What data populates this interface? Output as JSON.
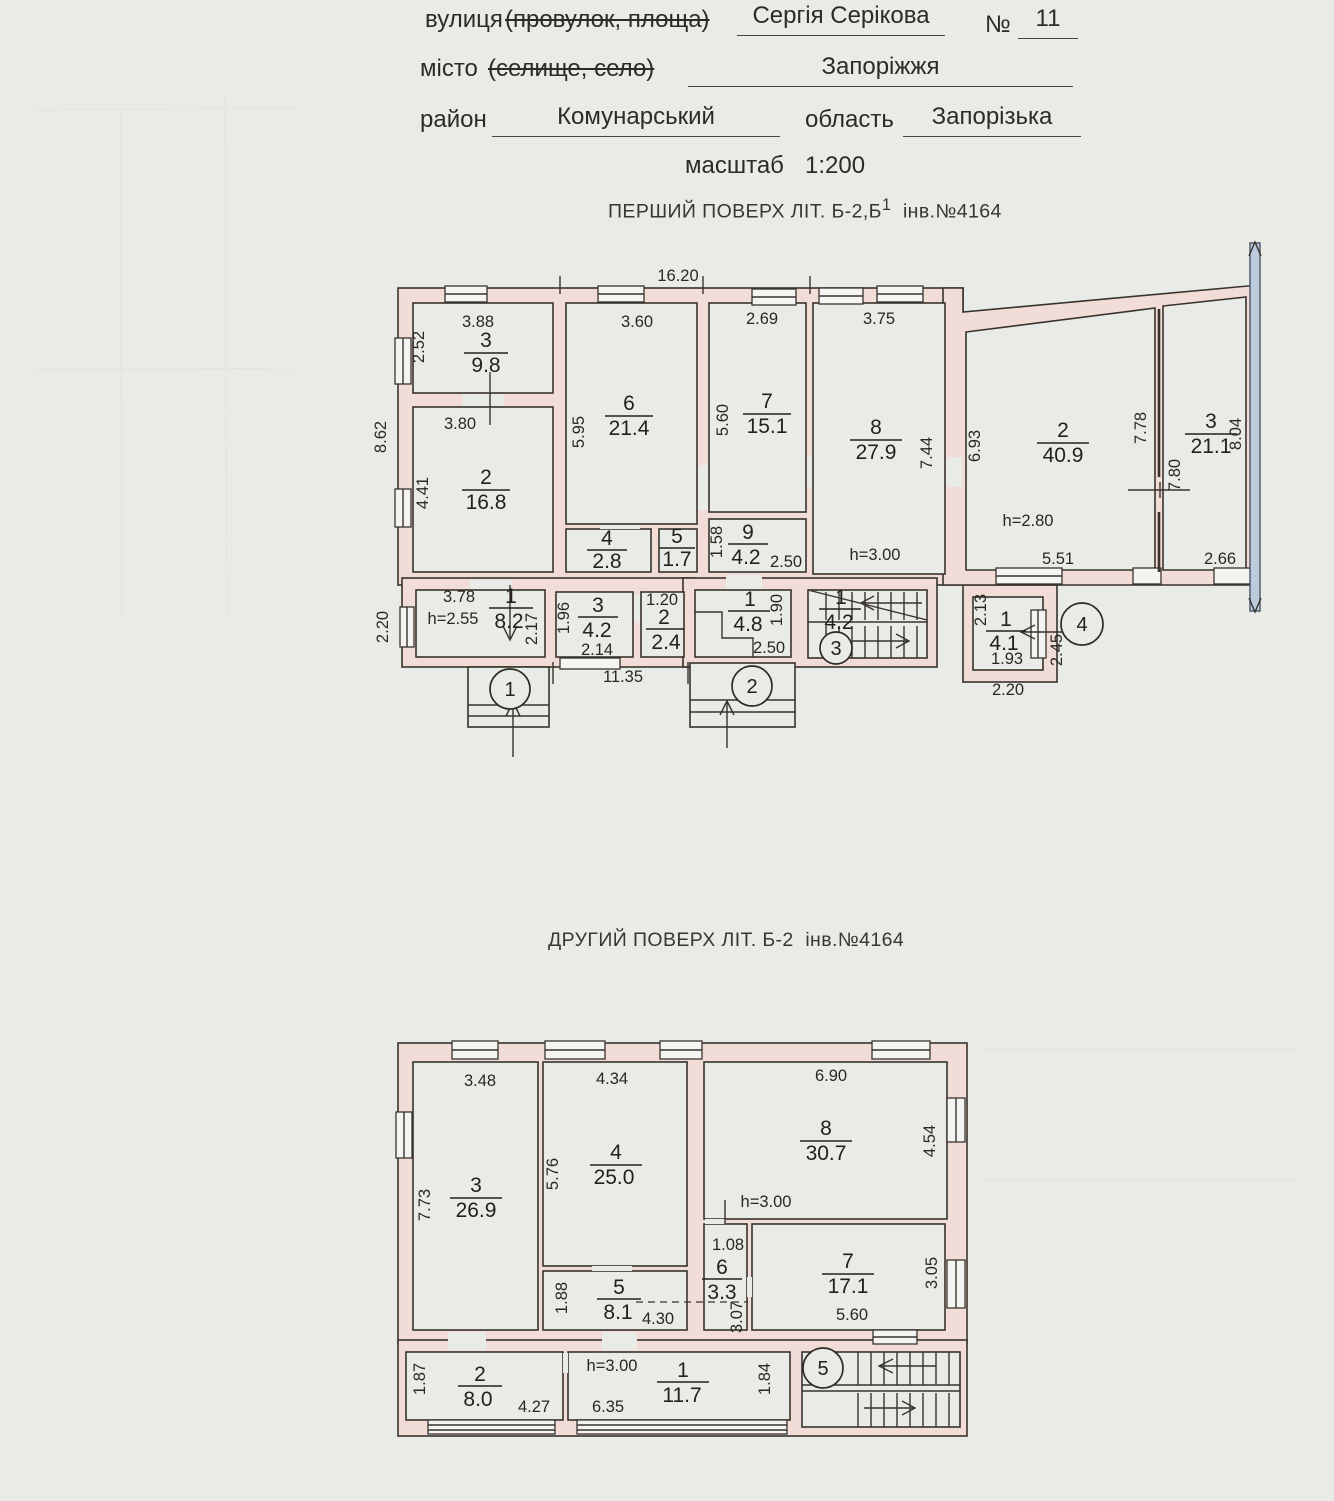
{
  "header": {
    "street_label": "вулиця",
    "street_paren": "(провулок, площа)",
    "street_value": "Сергія Серікова",
    "number_label": "№",
    "number_value": "11",
    "city_label": "місто",
    "city_paren": "(селище, село)",
    "city_value": "Запоріжжя",
    "district_label": "район",
    "district_value": "Комунарський",
    "region_label": "область",
    "region_value": "Запорізька",
    "scale_label": "масштаб",
    "scale_value": "1:200"
  },
  "floor1": {
    "title": "ПЕРШИЙ ПОВЕРХ ЛІТ. Б-2,Б",
    "title_sup": "1",
    "title_inv": "інв.№4164",
    "rooms": {
      "k3": {
        "num": "3",
        "area": "9.8"
      },
      "k2": {
        "num": "2",
        "area": "16.8"
      },
      "k6": {
        "num": "6",
        "area": "21.4"
      },
      "k4": {
        "num": "4",
        "area": "2.8"
      },
      "k5": {
        "num": "5",
        "area": "1.7"
      },
      "k7": {
        "num": "7",
        "area": "15.1"
      },
      "k8": {
        "num": "8",
        "area": "27.9"
      },
      "k9": {
        "num": "9",
        "area": "4.2"
      },
      "a2": {
        "num": "2",
        "area": "40.9"
      },
      "a3": {
        "num": "3",
        "area": "21.1"
      },
      "c1": {
        "num": "1",
        "area": "8.2"
      },
      "c3": {
        "num": "3",
        "area": "4.2"
      },
      "c2": {
        "num": "2",
        "area": "2.4"
      },
      "c48": {
        "num": "1",
        "area": "4.8"
      },
      "cst": {
        "num": "1",
        "area": "4.2"
      },
      "c41": {
        "num": "1",
        "area": "4.1"
      }
    },
    "heights": {
      "h8": "h=3.00",
      "ha2": "h=2.80",
      "hc1": "h=2.55"
    },
    "dims": {
      "top": "16.20",
      "left": "8.62",
      "left_low": "2.20",
      "r3w": "3.88",
      "r3h": "2.52",
      "r2w": "3.80",
      "r2h": "4.41",
      "r6w": "3.60",
      "r6h": "5.95",
      "r7w": "2.69",
      "r7h": "5.60",
      "r8w": "3.75",
      "r8h": "7.44",
      "r9h": "1.58",
      "r9w": "2.50",
      "annex_left": "6.93",
      "a2w": "5.51",
      "a3h1": "7.78",
      "a3h2": "7.80",
      "a3w": "2.66",
      "right": "8.04",
      "c1w": "3.78",
      "c1h": "2.17",
      "c3h": "1.96",
      "c3w": "2.14",
      "c2w": "1.20",
      "c48h": "1.90",
      "c48w": "2.50",
      "bottom": "11.35",
      "c41h": "2.13",
      "c41w": "1.93",
      "c41r": "2.45",
      "c41b": "2.20"
    },
    "markers": {
      "m1": "1",
      "m2": "2",
      "m3": "3",
      "m4": "4"
    }
  },
  "floor2": {
    "title": "ДРУГИЙ ПОВЕРХ ЛІТ. Б-2",
    "title_inv": "інв.№4164",
    "rooms": {
      "k3": {
        "num": "3",
        "area": "26.9"
      },
      "k4": {
        "num": "4",
        "area": "25.0"
      },
      "k5": {
        "num": "5",
        "area": "8.1"
      },
      "k8": {
        "num": "8",
        "area": "30.7"
      },
      "k6": {
        "num": "6",
        "area": "3.3"
      },
      "k7": {
        "num": "7",
        "area": "17.1"
      },
      "c2": {
        "num": "2",
        "area": "8.0"
      },
      "c1": {
        "num": "1",
        "area": "11.7"
      }
    },
    "heights": {
      "h6": "h=3.00",
      "hc": "h=3.00"
    },
    "dims": {
      "r3w": "3.48",
      "r3h": "7.73",
      "r4w": "4.34",
      "r4h": "5.76",
      "r8w": "6.90",
      "r8h": "4.54",
      "r5h": "1.88",
      "r5w": "4.30",
      "r6w": "1.08",
      "r6h": "3.07",
      "r7w": "5.60",
      "r7h": "3.05",
      "c2h": "1.87",
      "c2w": "4.27",
      "c1w": "6.35",
      "sth": "1.84"
    },
    "markers": {
      "m5": "5"
    }
  }
}
